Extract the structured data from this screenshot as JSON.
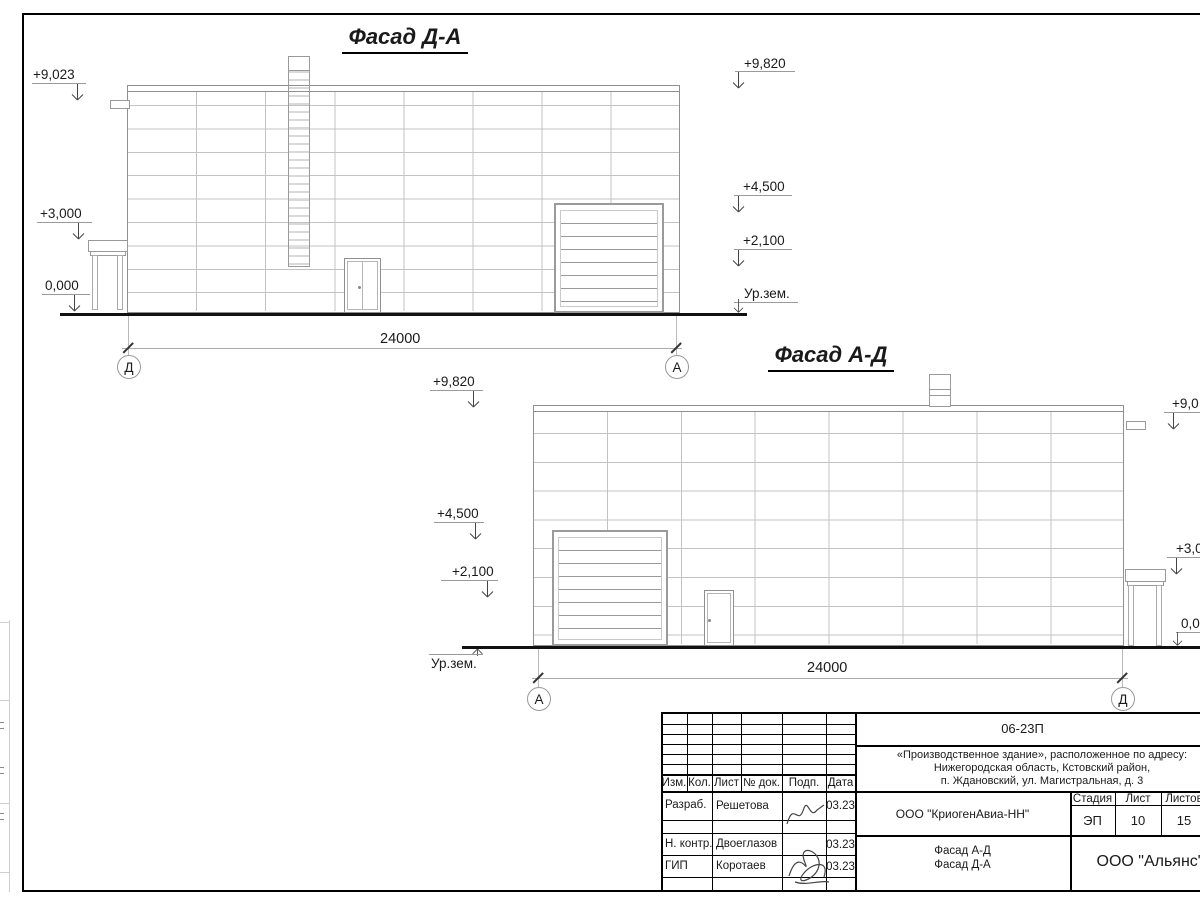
{
  "facade_top": {
    "title": "Фасад Д-А",
    "dimension": "24000",
    "axis_left": "Д",
    "axis_right": "А",
    "elevations_left": [
      "+9,023",
      "+3,000",
      "0,000"
    ],
    "elevations_right": [
      "+9,820",
      "+4,500",
      "+2,100",
      "Ур.зем."
    ]
  },
  "facade_bottom": {
    "title": "Фасад А-Д",
    "dimension": "24000",
    "axis_left": "А",
    "axis_right": "Д",
    "elevations_left": [
      "+9,820",
      "+4,500",
      "+2,100"
    ],
    "ground_label": "Ур.зем.",
    "elevations_right": [
      "+9,0",
      "+3,0",
      "0,0"
    ]
  },
  "title_block": {
    "doc_code": "06-23П",
    "address_lines": [
      "«Производственное здание», расположенное по адресу:",
      "Нижегородская область, Кстовский район,",
      "п. Ждановский, ул. Магистральная, д. 3"
    ],
    "rev_headers": [
      "Изм.",
      "Кол.",
      "Лист",
      "№ док.",
      "Подп.",
      "Дата"
    ],
    "signature_rows": [
      {
        "role": "Разраб.",
        "name": "Решетова",
        "date": "03.23"
      },
      {
        "role": "Н. контр.",
        "name": "Двоеглазов",
        "date": "03.23"
      },
      {
        "role": "ГИП",
        "name": "Коротаев",
        "date": "03.23"
      }
    ],
    "designer_company": "ООО \"КриогенАвиа-НН\"",
    "stage_header": "Стадия",
    "sheet_header": "Лист",
    "sheets_header": "Листов",
    "stage": "ЭП",
    "sheet": "10",
    "sheets": "15",
    "drawing_titles": [
      "Фасад А-Д",
      "Фасад Д-А"
    ],
    "contractor_company": "ООО \"Альянс\""
  }
}
